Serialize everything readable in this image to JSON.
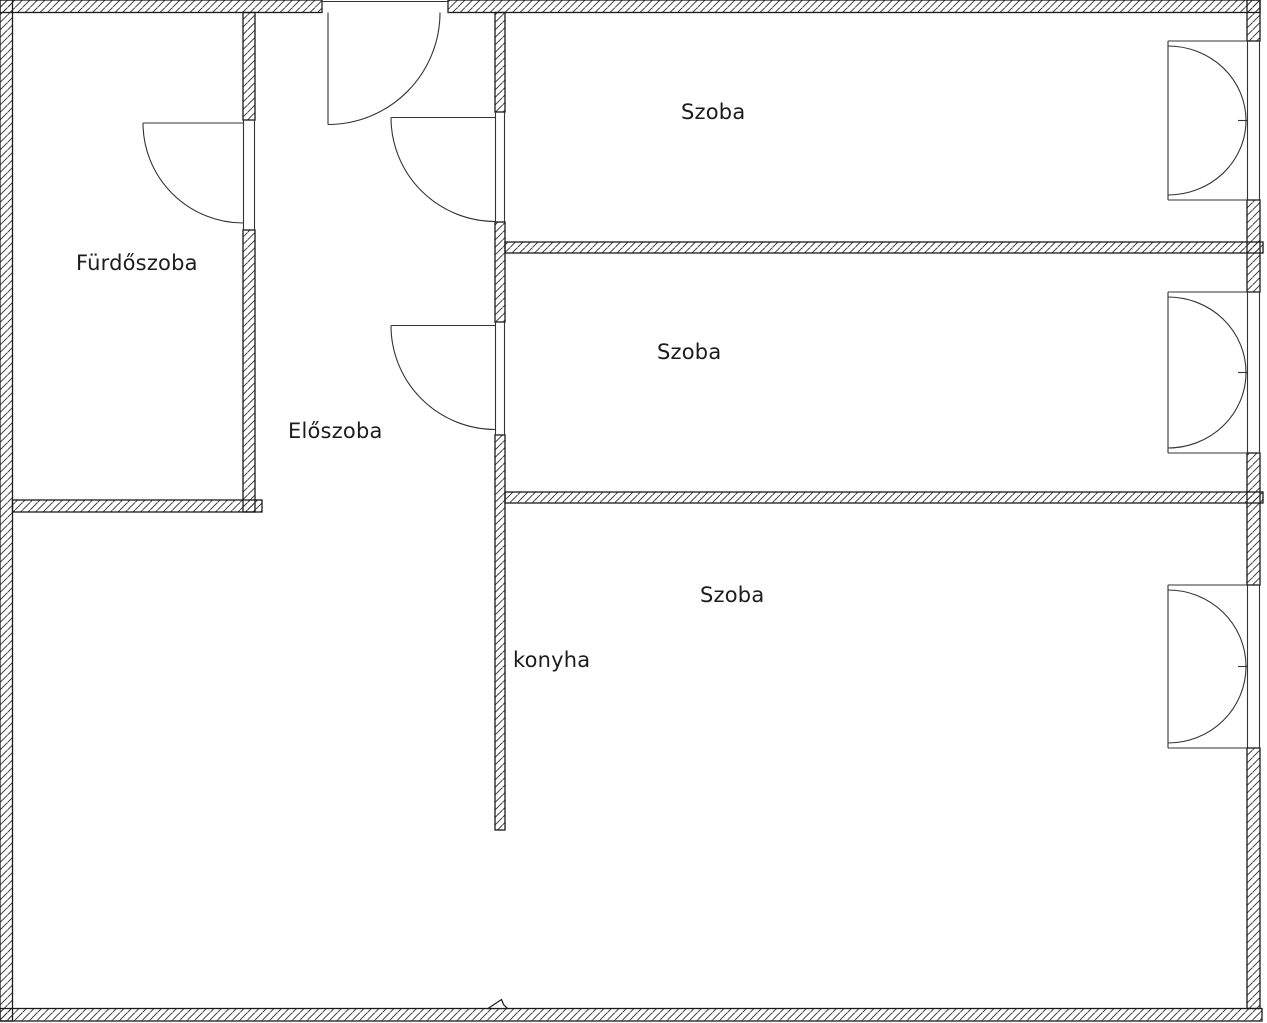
{
  "colors": {
    "background": "#ffffff",
    "wall_line": "#1a1a1a",
    "thin_line": "#333333",
    "text": "#1c1c1c"
  },
  "rooms": [
    {
      "id": "bathroom",
      "label": "Fürdőszoba"
    },
    {
      "id": "hallway",
      "label": "Előszoba"
    },
    {
      "id": "room-1",
      "label": "Szoba"
    },
    {
      "id": "room-2",
      "label": "Szoba"
    },
    {
      "id": "room-3",
      "label": "Szoba"
    },
    {
      "id": "kitchen",
      "label": "konyha"
    }
  ],
  "fixtures": {
    "doors": 4,
    "windows": 3
  }
}
